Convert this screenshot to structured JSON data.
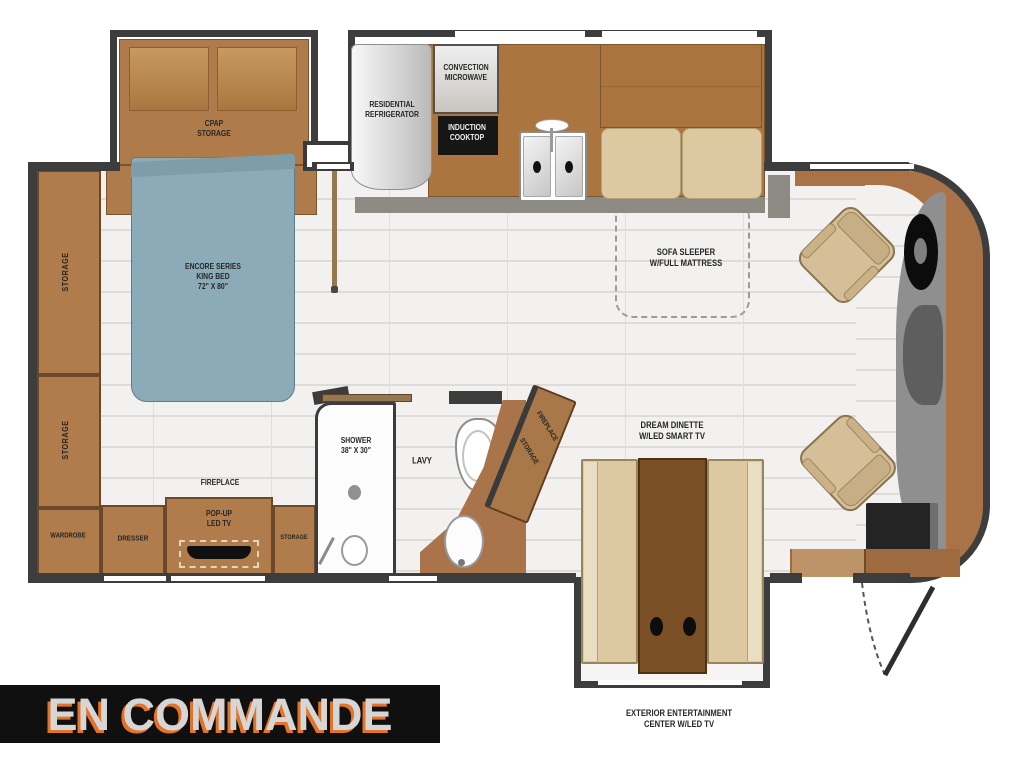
{
  "banner": {
    "label": "EN COMMANDE"
  },
  "bedroom": {
    "cpap1": "CPAP",
    "cpap2": "STORAGE",
    "bed1": "ENCORE SERIES",
    "bed2": "KING BED",
    "bed3": "72\" X 80\"",
    "storage_upper": "STORAGE",
    "storage_lower": "STORAGE",
    "wardrobe": "WARDROBE",
    "dresser": "DRESSER",
    "fireplace": "FIREPLACE",
    "tv1": "POP-UP",
    "tv2": "LED TV",
    "storage_small": "STORAGE"
  },
  "kitchen": {
    "fridge1": "RESIDENTIAL",
    "fridge2": "REFRIGERATOR",
    "micro1": "CONVECTION",
    "micro2": "MICROWAVE",
    "cook1": "INDUCTION",
    "cook2": "COOKTOP"
  },
  "bathroom": {
    "shower1": "SHOWER",
    "shower2": "38\" X 30\"",
    "lavy": "LAVY"
  },
  "living": {
    "sofa1": "SOFA SLEEPER",
    "sofa2": "W/FULL MATTRESS",
    "dinette1": "DREAM DINETTE",
    "dinette2": "W/LED SMART TV",
    "fireplace_angled": "FIREPLACE",
    "storage_angled": "STORAGE"
  },
  "exterior": {
    "ext1": "EXTERIOR ENTERTAINMENT",
    "ext2": "CENTER W/LED TV"
  },
  "colors": {
    "wall": "#3d3d3d",
    "cabinet_brown": "#b17c4b",
    "dark_table_brown": "#7b4f26",
    "cushion_tan": "#dcc9a2",
    "bed_blue": "#8cabb8",
    "floor": "#f2f1ef",
    "banner_bg": "#101010",
    "banner_text": "#d6d6d6",
    "banner_shadow": "#e4732a",
    "appliance_black": "#161616",
    "stainless": "#d8d8d8"
  }
}
